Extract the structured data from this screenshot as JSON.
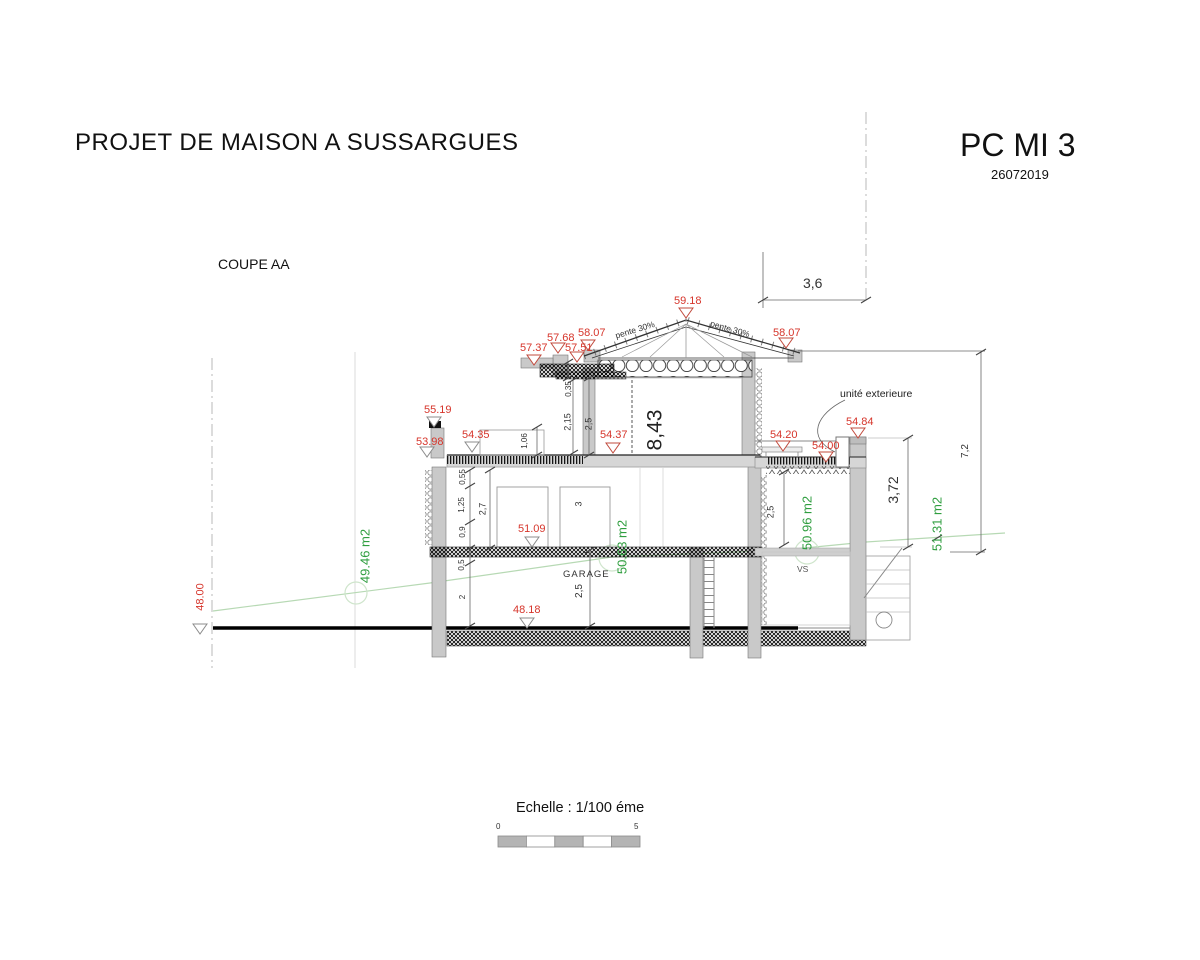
{
  "header": {
    "title": "PROJET DE MAISON A SUSSARGUES",
    "doc_code": "PC MI 3",
    "doc_date": "26072019"
  },
  "section": {
    "name": "COUPE AA"
  },
  "levels": {
    "ridge": "59.18",
    "eave_left": "58.07",
    "eave_right": "58.07",
    "upper_slab_a": "57.68",
    "upper_slab_b": "57.51",
    "upper_slab_c": "57.37",
    "parapet": "55.19",
    "terrace_left": "54.35",
    "soffit_left": "53.98",
    "floor_upper": "54.37",
    "terrace_right_a": "54.20",
    "terrace_right_b": "54.00",
    "wall_cap_right": "54.84",
    "floor_ground": "51.09",
    "floor_garage": "48.18",
    "terrain_left": "48.00"
  },
  "areas": {
    "left": "49.46 m2",
    "garage": "50.63 m2",
    "right": "50.96 m2",
    "far_right": "51.31 m2"
  },
  "dimensions": {
    "overhang_width": "3,6",
    "total_height_right": "7,2",
    "right_drop": "3,72",
    "total_height_center": "8,43",
    "upper_a": "0,35",
    "upper_b": "2,15",
    "upper_c": "2,5",
    "terrace_window": "1,06",
    "gf_a": "0,55",
    "gf_b": "1,25",
    "gf_c": "0,9",
    "gf_room": "2,7",
    "gf_slab": "0,5",
    "garage_wall": "2",
    "gf_door": "3",
    "garage_room": "2,5",
    "right_room": "2,5"
  },
  "labels": {
    "slope_left": "pente 30%",
    "slope_right": "pente 30%",
    "exterior_unit": "unité exterieure",
    "garage": "GARAGE",
    "crawl_space": "VS"
  },
  "scale": {
    "caption": "Echelle : 1/100 éme",
    "start": "0",
    "end": "5"
  },
  "colors": {
    "level_marker_red": "#d6352b",
    "area_text_green": "#2f9e3f",
    "terrain_line_green": "#b7d9b4",
    "dimension_text": "#333333",
    "wall_fill_gray": "#c9c9c9"
  }
}
